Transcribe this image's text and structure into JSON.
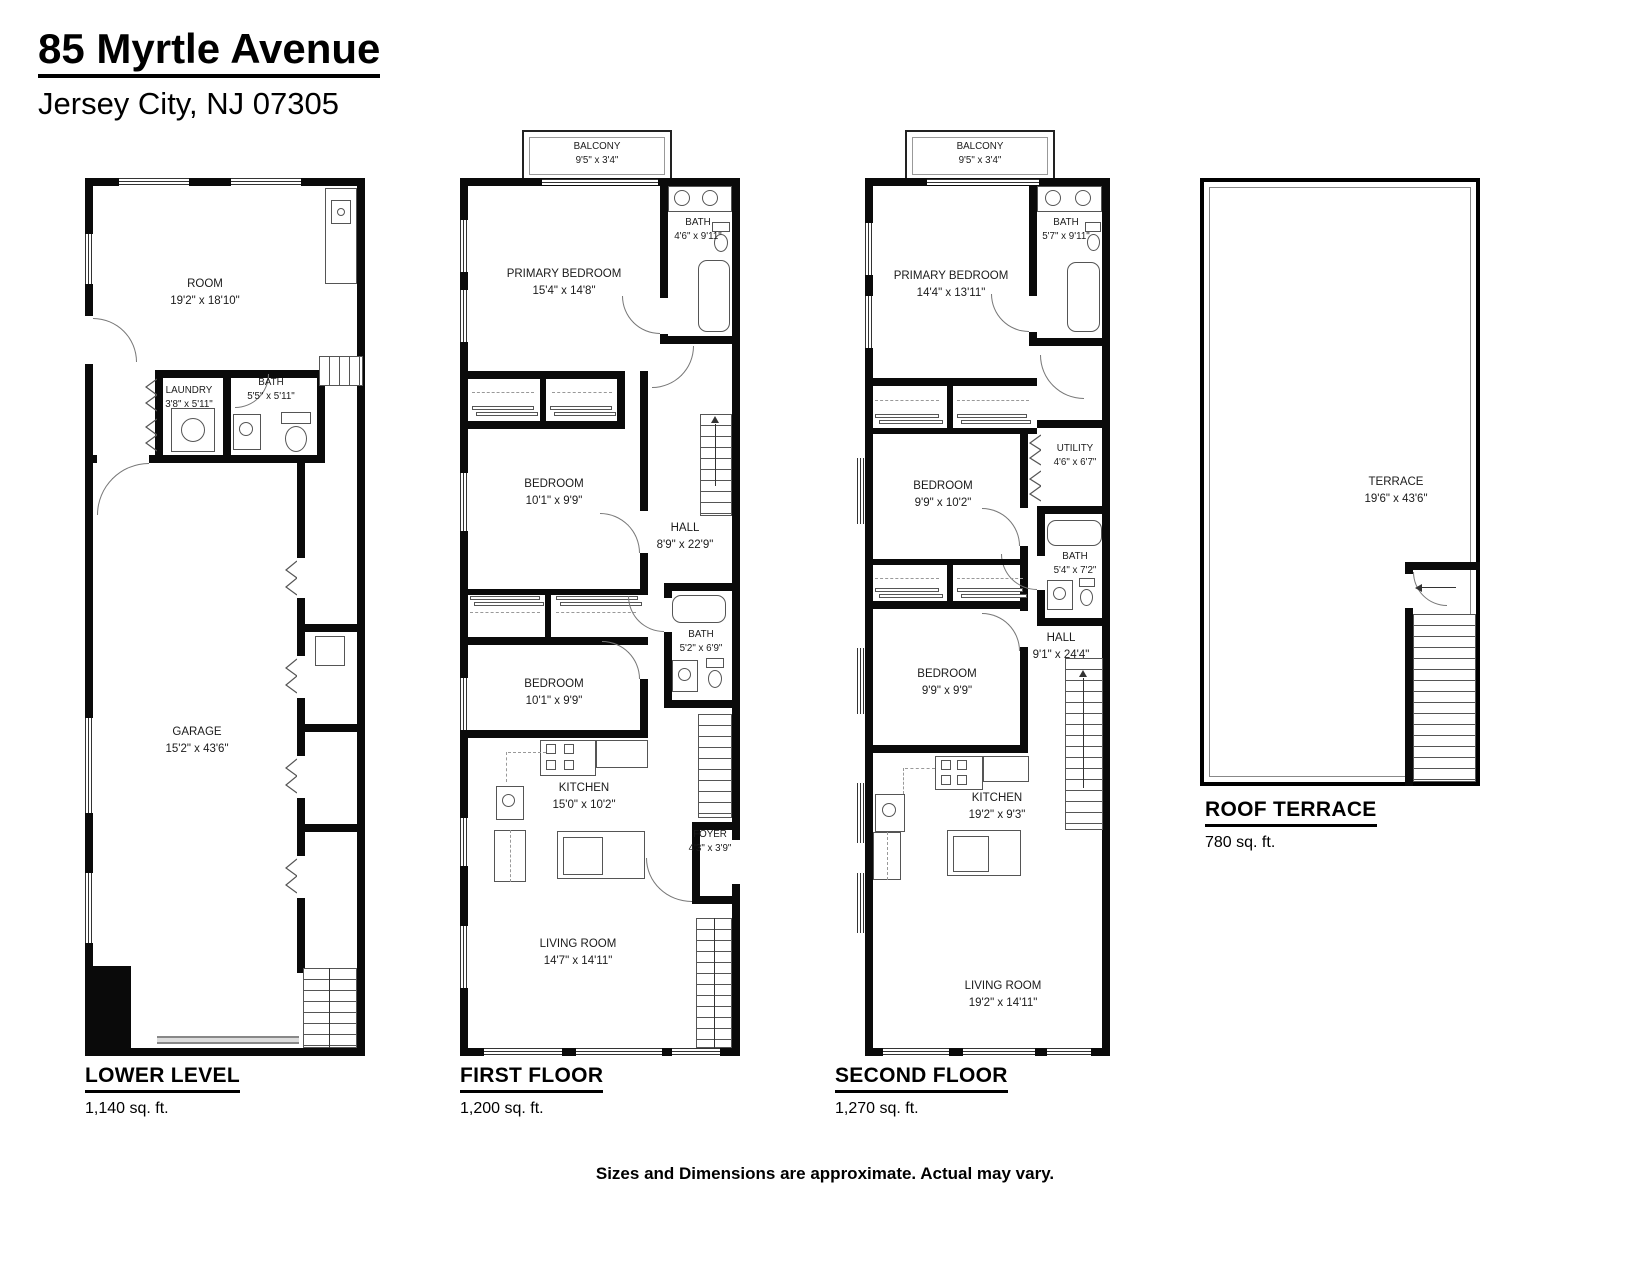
{
  "header": {
    "title": "85 Myrtle Avenue",
    "subtitle": "Jersey City, NJ 07305"
  },
  "footer": {
    "disclaimer": "Sizes and Dimensions are approximate. Actual may vary."
  },
  "colors": {
    "wall": "#0a0a0a",
    "line": "#555555",
    "accent": "#000000"
  },
  "plans": [
    {
      "name": "LOWER LEVEL",
      "area": "1,140 sq. ft.",
      "rooms": [
        {
          "label": "ROOM",
          "dims": "19'2\" x 18'10\""
        },
        {
          "label": "LAUNDRY",
          "dims": "3'8\" x 5'11\""
        },
        {
          "label": "BATH",
          "dims": "5'5\" x 5'11\""
        },
        {
          "label": "GARAGE",
          "dims": "15'2\" x 43'6\""
        }
      ]
    },
    {
      "name": "FIRST FLOOR",
      "area": "1,200 sq. ft.",
      "rooms": [
        {
          "label": "BALCONY",
          "dims": "9'5\" x 3'4\""
        },
        {
          "label": "PRIMARY BEDROOM",
          "dims": "15'4\" x 14'8\""
        },
        {
          "label": "BATH",
          "dims": "4'6\" x 9'11\""
        },
        {
          "label": "BEDROOM",
          "dims": "10'1\" x 9'9\""
        },
        {
          "label": "HALL",
          "dims": "8'9\" x 22'9\""
        },
        {
          "label": "BEDROOM",
          "dims": "10'1\" x 9'9\""
        },
        {
          "label": "BATH",
          "dims": "5'2\" x 6'9\""
        },
        {
          "label": "KITCHEN",
          "dims": "15'0\" x 10'2\""
        },
        {
          "label": "FOYER",
          "dims": "4'3\" x 3'9\""
        },
        {
          "label": "LIVING ROOM",
          "dims": "14'7\" x 14'11\""
        }
      ]
    },
    {
      "name": "SECOND FLOOR",
      "area": "1,270 sq. ft.",
      "rooms": [
        {
          "label": "BALCONY",
          "dims": "9'5\" x 3'4\""
        },
        {
          "label": "PRIMARY BEDROOM",
          "dims": "14'4\" x 13'11\""
        },
        {
          "label": "BATH",
          "dims": "5'7\" x 9'11\""
        },
        {
          "label": "BEDROOM",
          "dims": "9'9\" x 10'2\""
        },
        {
          "label": "UTILITY",
          "dims": "4'6\" x 6'7\""
        },
        {
          "label": "BATH",
          "dims": "5'4\" x 7'2\""
        },
        {
          "label": "HALL",
          "dims": "9'1\" x 24'4\""
        },
        {
          "label": "BEDROOM",
          "dims": "9'9\" x 9'9\""
        },
        {
          "label": "KITCHEN",
          "dims": "19'2\" x 9'3\""
        },
        {
          "label": "LIVING ROOM",
          "dims": "19'2\" x 14'11\""
        }
      ]
    },
    {
      "name": "ROOF TERRACE",
      "area": "780 sq. ft.",
      "rooms": [
        {
          "label": "TERRACE",
          "dims": "19'6\" x 43'6\""
        }
      ]
    }
  ]
}
